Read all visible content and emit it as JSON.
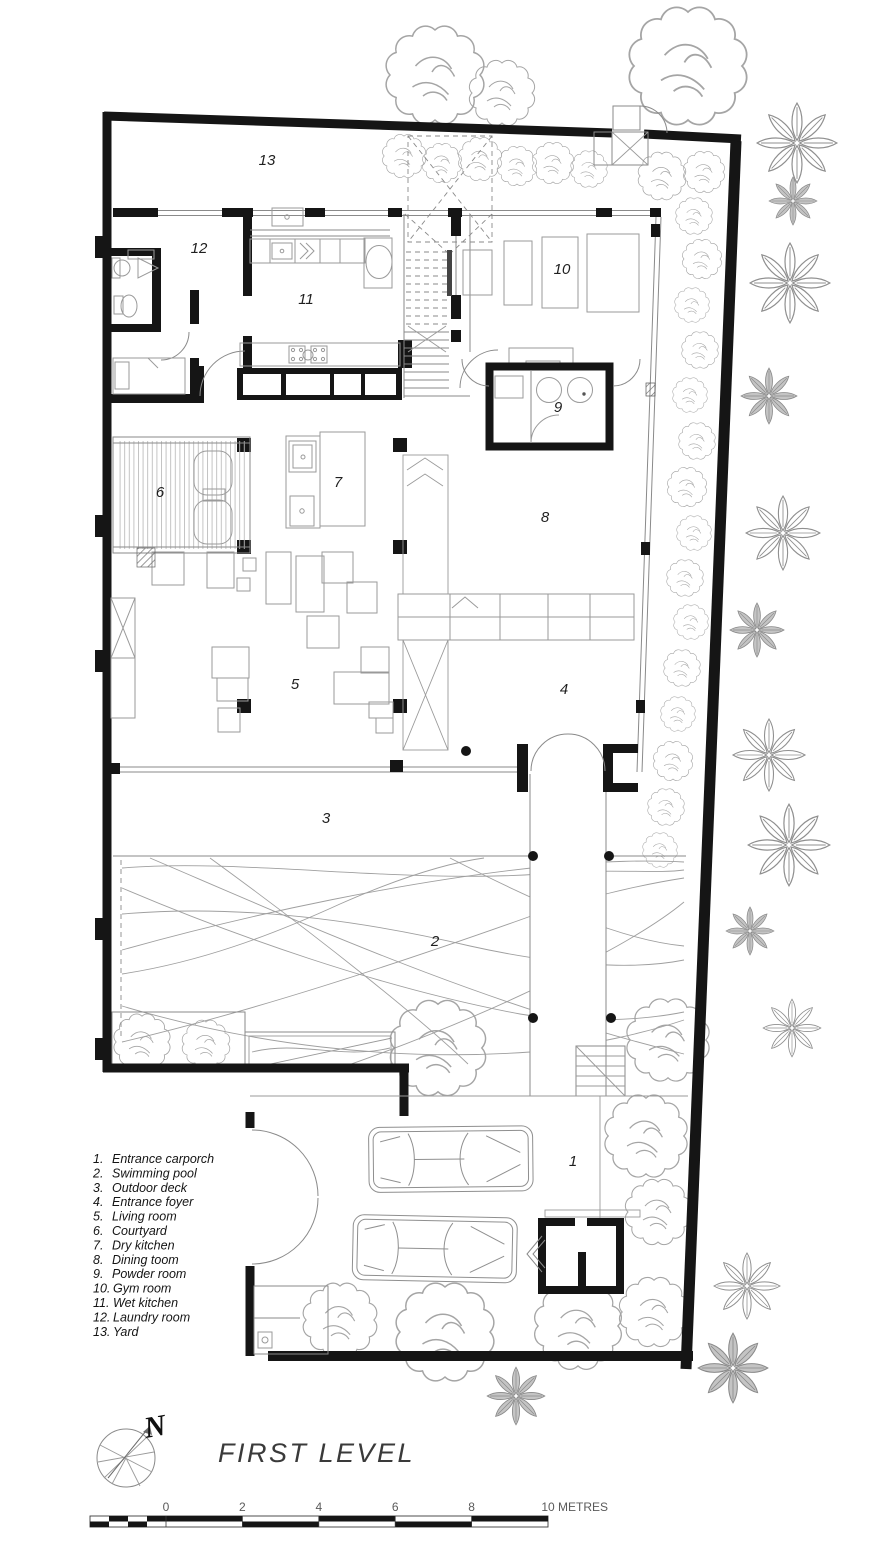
{
  "plan": {
    "title": "FIRST LEVEL",
    "north_letter": "N",
    "rooms": [
      {
        "id": "1.",
        "number": "1",
        "name": "Entrance carporch"
      },
      {
        "id": "2.",
        "number": "2",
        "name": "Swimming pool"
      },
      {
        "id": "3.",
        "number": "3",
        "name": "Outdoor deck"
      },
      {
        "id": "4.",
        "number": "4",
        "name": "Entrance foyer"
      },
      {
        "id": "5.",
        "number": "5",
        "name": "Living room"
      },
      {
        "id": "6.",
        "number": "6",
        "name": "Courtyard"
      },
      {
        "id": "7.",
        "number": "7",
        "name": "Dry kitchen"
      },
      {
        "id": "8.",
        "number": "8",
        "name": "Dining toom"
      },
      {
        "id": "9.",
        "number": "9",
        "name": "Powder room"
      },
      {
        "id": "10.",
        "number": "10",
        "name": "Gym room"
      },
      {
        "id": "11.",
        "number": "11",
        "name": "Wet kitchen"
      },
      {
        "id": "12.",
        "number": "12",
        "name": "Laundry room"
      },
      {
        "id": "13.",
        "number": "13",
        "name": "Yard"
      }
    ],
    "scale_bar": {
      "labels": [
        "0",
        "2",
        "4",
        "6",
        "8",
        "10"
      ],
      "unit": "METRES"
    },
    "colors": {
      "wall": "#151515",
      "line": "#8a8a8a",
      "vegetation": "#a5a5a5",
      "text": "#1f1f1f",
      "background": "#ffffff"
    }
  }
}
